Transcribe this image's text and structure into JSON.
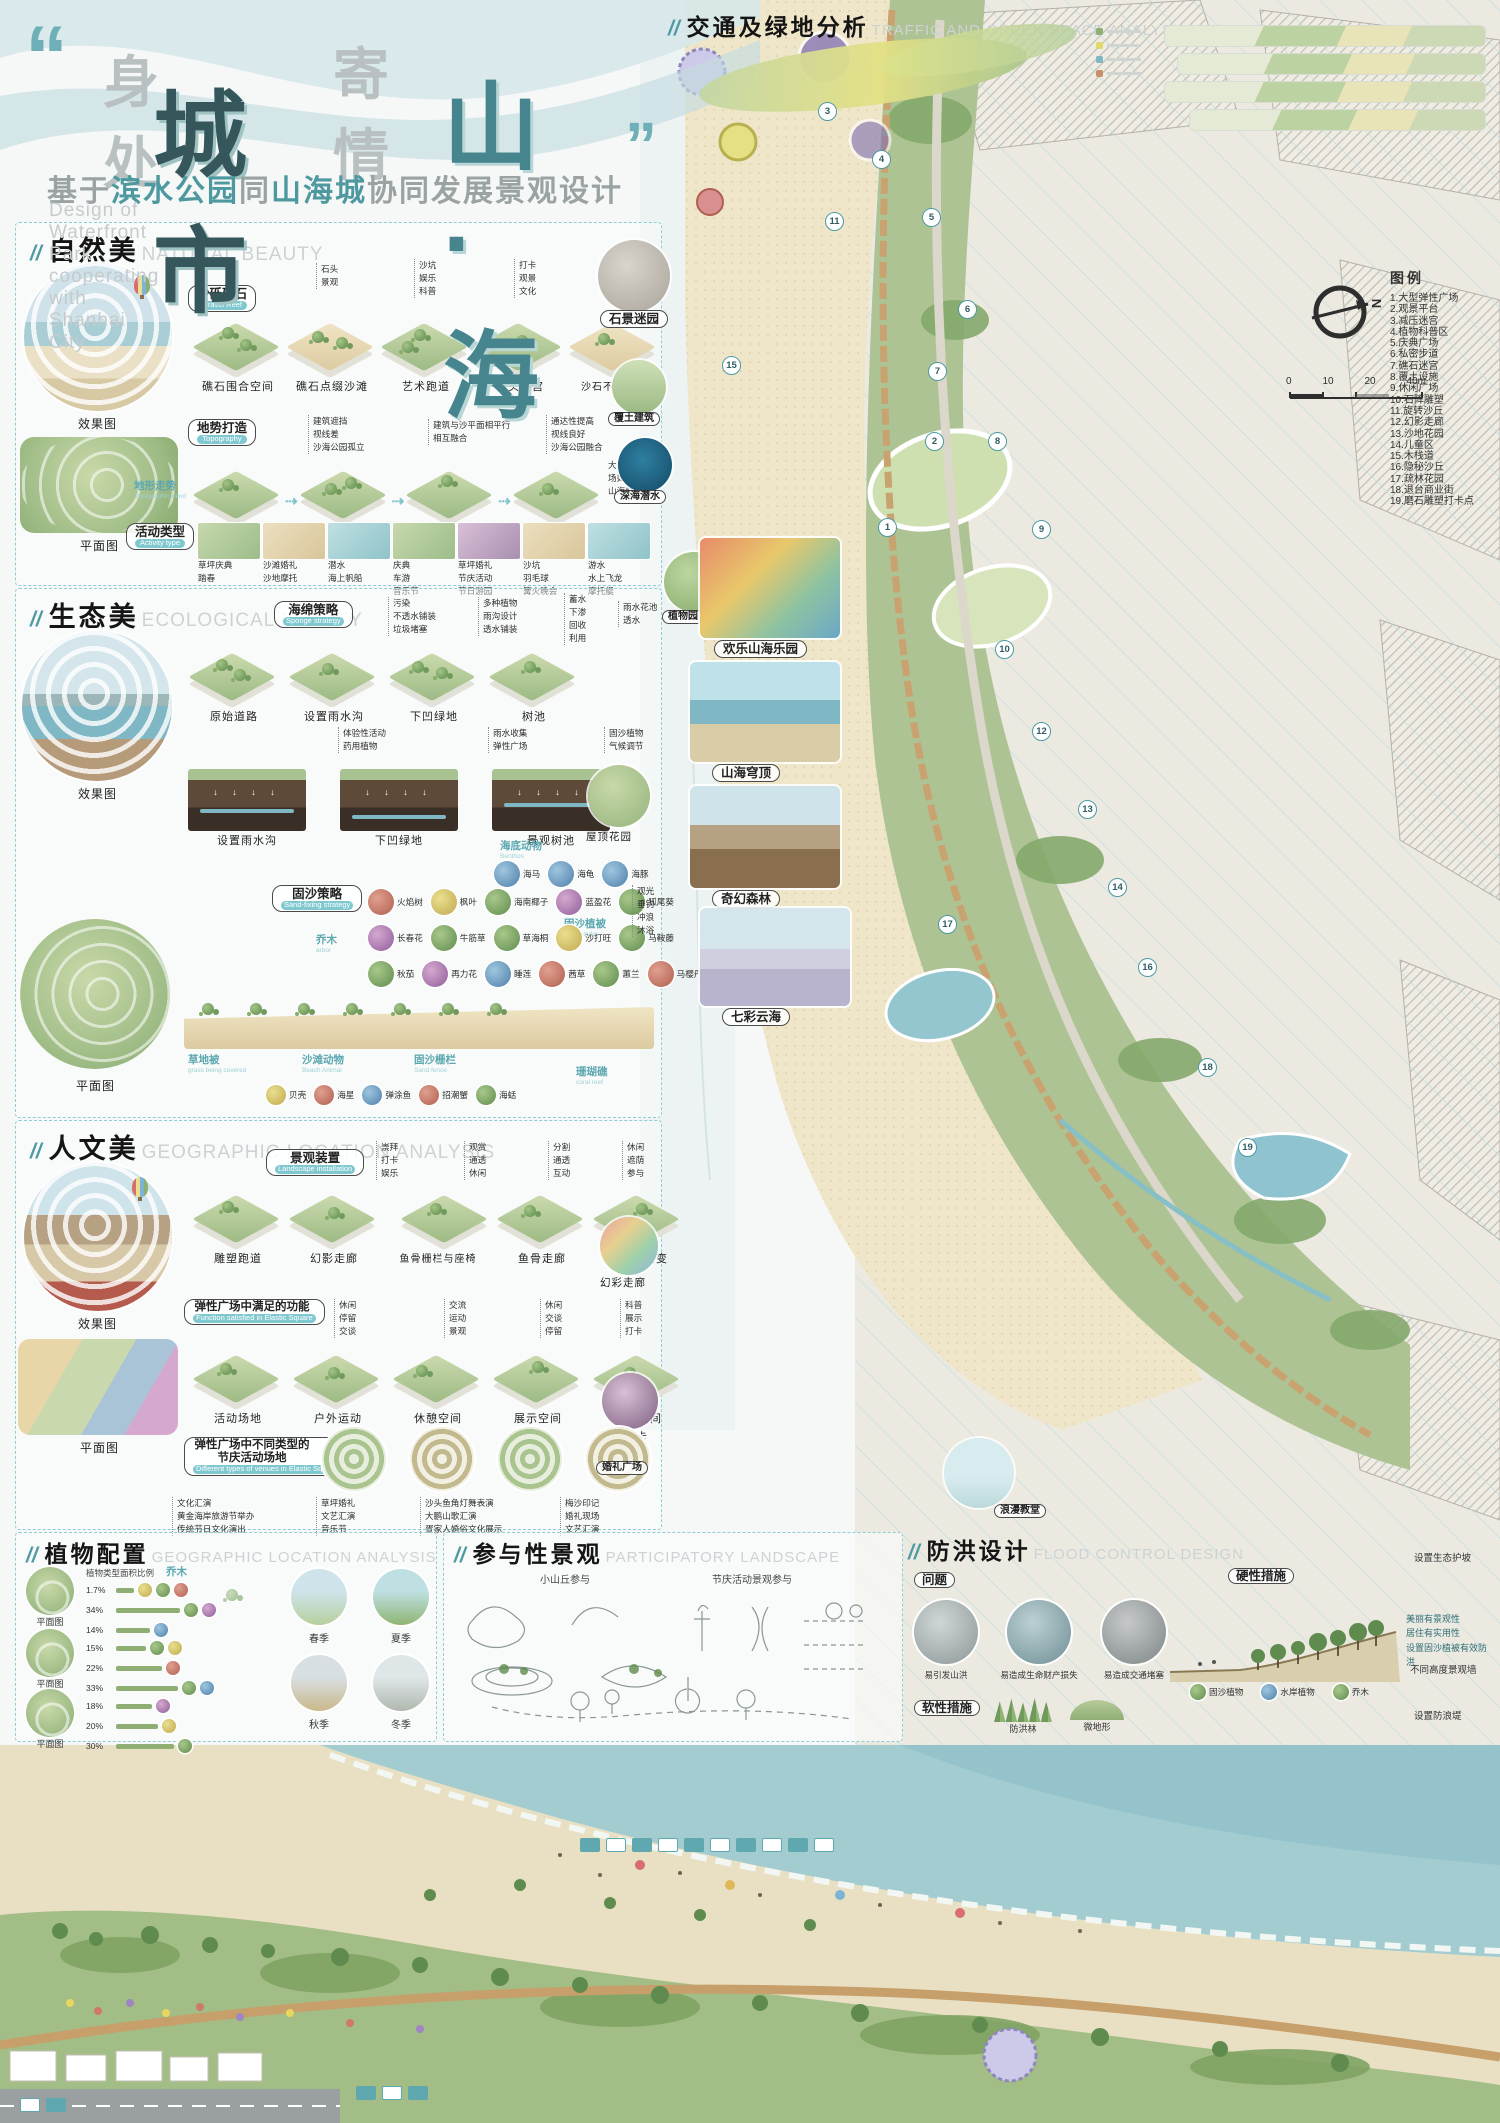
{
  "ui": {
    "slash": "//",
    "quote_open": "“",
    "quote_close": "”"
  },
  "header": {
    "t1": "身处",
    "t2": "城市",
    "t3": "寄情",
    "t4": "山·海",
    "sub1": "基于",
    "sub2": "滨水公园",
    "sub3": "同",
    "sub4": "山海城",
    "sub5": "协同发展景观设计",
    "sub_en": "Design of Waterfront Park cooperating with Shanhai City"
  },
  "traffic": {
    "title": "交通及绿地分析",
    "subtitle": "TRAFFIC AND GREEN SPACE ANALYSIS"
  },
  "legend": {
    "title": "图例",
    "items": [
      "1.大型弹性广场",
      "2.观景平台",
      "3.减压迷宫",
      "4.植物科普区",
      "5.庆典广场",
      "6.私密步道",
      "7.礁石迷宫",
      "8.覆土设施",
      "9.休闲广场",
      "10.石阵雕塑",
      "11.旋转沙丘",
      "12.幻影走廊",
      "13.沙地花园",
      "14.儿童区",
      "15.木栈道",
      "16.隐秘沙丘",
      "17.疏林花园",
      "18.退台商业街",
      "19.磨石雕塑打卡点"
    ]
  },
  "map": {
    "compass": "N",
    "scale_ticks": [
      "0",
      "10",
      "20",
      "40m"
    ],
    "markers": [
      "1",
      "2",
      "3",
      "4",
      "5",
      "6",
      "7",
      "8",
      "9",
      "10",
      "11",
      "12",
      "13",
      "14",
      "15",
      "16",
      "17",
      "18",
      "19"
    ],
    "callout1": "石景迷园",
    "callout2": "欢乐山海乐园",
    "callout3": "山海穹顶",
    "callout4": "奇幻森林",
    "callout5": "七彩云海",
    "side1": "覆土建筑",
    "side2": "深海潜水",
    "garden": "植物园"
  },
  "s1": {
    "title": "自然美",
    "subtitle": "NATURAL BEAUTY",
    "effect_label": "效果图",
    "plan_label": "平面图",
    "chip1": {
      "zh": "沙砾礁石",
      "en": "Gravel Reef"
    },
    "g1": [
      "石头",
      "景观"
    ],
    "g2": [
      "沙坑",
      "娱乐",
      "科普"
    ],
    "g3": [
      "打卡",
      "观景",
      "文化"
    ],
    "tiles1": [
      "礁石围合空间",
      "礁石点缀沙滩",
      "艺术跑道",
      "石头迷宫",
      "沙石不同铺装"
    ],
    "chip2": {
      "zh": "地势打造",
      "en": "Topography"
    },
    "n1": [
      "建筑遮挡",
      "视线差",
      "沙海公园孤立"
    ],
    "n2": [
      "建筑与沙平面相平行",
      "相互融合"
    ],
    "n3": [
      "通达性提高",
      "视线良好",
      "沙海公园融合"
    ],
    "flow": [
      "孤立",
      "相融合",
      "微地形打造",
      "覆土建筑"
    ],
    "side_note": "大型活动现场如演唱会\n山海城影响",
    "chip3": {
      "zh": "活动类型",
      "en": "Activity type"
    },
    "chip4": {
      "zh": "地形走势",
      "en": "Topographic trend"
    },
    "acts": [
      [
        "草坪庆典",
        "踏春"
      ],
      [
        "沙滩婚礼",
        "沙地摩托"
      ],
      [
        "潜水",
        "海上帆船"
      ],
      [
        "庆典",
        "车游",
        "音乐节"
      ],
      [
        "草坪婚礼",
        "节庆活动",
        "节日游园"
      ],
      [
        "沙坑",
        "羽毛球",
        "篝火晚会"
      ],
      [
        "游水",
        "水上飞龙",
        "摩托艇"
      ]
    ]
  },
  "s2": {
    "title": "生态美",
    "subtitle": "ECOLOGICAL BEAUTY",
    "effect_label": "效果图",
    "plan_label": "平面图",
    "chip1": {
      "zh": "海绵策略",
      "en": "Sponge strategy"
    },
    "g1": [
      "污染",
      "不透水铺装",
      "垃圾堵塞"
    ],
    "g2": [
      "多种植物",
      "雨沟设计",
      "透水铺装"
    ],
    "g3": [
      "蓄水",
      "下渗",
      "回收",
      "利用"
    ],
    "g4": [
      "雨水花池",
      "透水"
    ],
    "tiles": [
      "原始道路",
      "设置雨水沟",
      "下凹绿地",
      "树池"
    ],
    "tn1": [
      "体验性活动",
      "药用植物"
    ],
    "tn2": [
      "雨水收集",
      "弹性广场"
    ],
    "tn3": [
      "固沙植物",
      "气候调节"
    ],
    "xsecs": [
      "设置雨水沟",
      "下凹绿地",
      "景观树池"
    ],
    "circ1": "屋顶花园",
    "chip2": {
      "zh": "固沙策略",
      "en": "Sand-fixing strategy"
    },
    "plants1": [
      "火焰树",
      "枫叶",
      "海南椰子",
      "蓝盈花",
      "狐尾葵"
    ],
    "plants2": [
      "长春花",
      "牛筋草",
      "草海桐",
      "沙打旺",
      "马鞍藤"
    ],
    "plants3": [
      "秋茄",
      "再力花",
      "睡莲",
      "茜草",
      "蕙兰",
      "马樱丹"
    ],
    "grp_arbor": {
      "zh": "乔木",
      "en": "arbor"
    },
    "grp_binder": {
      "zh": "固沙植被",
      "en": "sand binder"
    },
    "grp_grass": {
      "zh": "草地被",
      "en": "grass being covered"
    },
    "grp_animal": {
      "zh": "沙滩动物",
      "en": "Beach Animal"
    },
    "grp_fence": {
      "zh": "固沙栅栏",
      "en": "Sand fence"
    },
    "grp_benthos": {
      "zh": "海底动物",
      "en": "Benthos"
    },
    "grp_coral": {
      "zh": "珊瑚礁",
      "en": "coral reef"
    },
    "animals": [
      "贝壳",
      "海星",
      "弹涂鱼",
      "招潮蟹",
      "海蛞"
    ],
    "benthos": [
      "海马",
      "海龟",
      "海豚"
    ],
    "beach_acts": [
      "观光",
      "垂钓",
      "冲浪",
      "沐浴"
    ]
  },
  "s3": {
    "title": "人文美",
    "subtitle": "GEOGRAPHIC LOCATION ANALYSIS",
    "effect_label": "效果图",
    "plan_label": "平面图",
    "chip1": {
      "zh": "景观装置",
      "en": "Landscape installation"
    },
    "g1": [
      "崇拜",
      "打卡",
      "娱乐"
    ],
    "g2": [
      "观赏",
      "通透",
      "休闲"
    ],
    "g3": [
      "分割",
      "通透",
      "互动"
    ],
    "g4": [
      "休闲",
      "遮荫",
      "参与"
    ],
    "tiles1": [
      "雕塑跑道",
      "幻影走廊",
      "鱼骨栅栏与座椅",
      "鱼骨走廊",
      "超级变变变"
    ],
    "circ1": "幻彩走廊",
    "chip2": {
      "zh": "弹性广场中满足的功能",
      "en": "Function satisfied in Elastic Square"
    },
    "f1": [
      "休闲",
      "停留",
      "交谈"
    ],
    "f2": [
      "交流",
      "运动",
      "景观"
    ],
    "f3": [
      "休闲",
      "交谈",
      "停留"
    ],
    "f4": [
      "科普",
      "展示",
      "打卡"
    ],
    "tiles2": [
      "活动场地",
      "户外运动",
      "休憩空间",
      "展示空间",
      "观景空间"
    ],
    "circ2": "网红打卡",
    "chip3": {
      "zh": "弹性广场中不同类型的节庆活动场地",
      "en": "Different types of venues in Elastic Square"
    },
    "plaza_label": "婚礼广场",
    "e1": [
      "文化汇演",
      "黄金海岸旅游节举办",
      "传统节日文化演出"
    ],
    "e2": [
      "草坪婚礼",
      "文艺汇演",
      "音乐节"
    ],
    "e3": [
      "沙头鱼角灯舞表演",
      "大鹏山歌汇演",
      "疍家人婚俗文化展示"
    ],
    "e4": [
      "梅沙印记",
      "婚礼现场",
      "文艺汇演"
    ]
  },
  "plants": {
    "title": "植物配置",
    "subtitle": "GEOGRAPHIC LOCATION ANALYSIS",
    "plan_label": "平面图",
    "chart_label": "植物类型面积比例",
    "arbor": "乔木",
    "pct1": [
      "1.7%",
      "34%",
      "14%"
    ],
    "pct2": [
      "15%",
      "22%",
      "33%"
    ],
    "pct3": [
      "18%",
      "20%",
      "30%"
    ],
    "seasons": [
      "春季",
      "夏季",
      "秋季",
      "冬季"
    ]
  },
  "part": {
    "title": "参与性景观",
    "subtitle": "PARTICIPATORY LANDSCAPE",
    "col1": "小山丘参与",
    "col2": "节庆活动景观参与"
  },
  "flood": {
    "title": "防洪设计",
    "subtitle": "FLOOD CONTROL DESIGN",
    "problem": "问题",
    "problems": [
      "易引发山洪",
      "易造成生命财产损失",
      "易造成交通堵塞"
    ],
    "soft": "软性措施",
    "soft1": "防洪林",
    "soft2": "微地形",
    "hard": "硬性措施",
    "hard_notes": [
      "美丽有景观性",
      "居住有实用性",
      "设置固沙植被有效防洪"
    ],
    "plants_row": [
      "固沙植物",
      "水岸植物",
      "乔木"
    ],
    "rn1": "设置生态护坡",
    "rn2": "不同高度景观墙",
    "rn3": "设置防浪堤",
    "chapel": "浪漫教堂"
  }
}
